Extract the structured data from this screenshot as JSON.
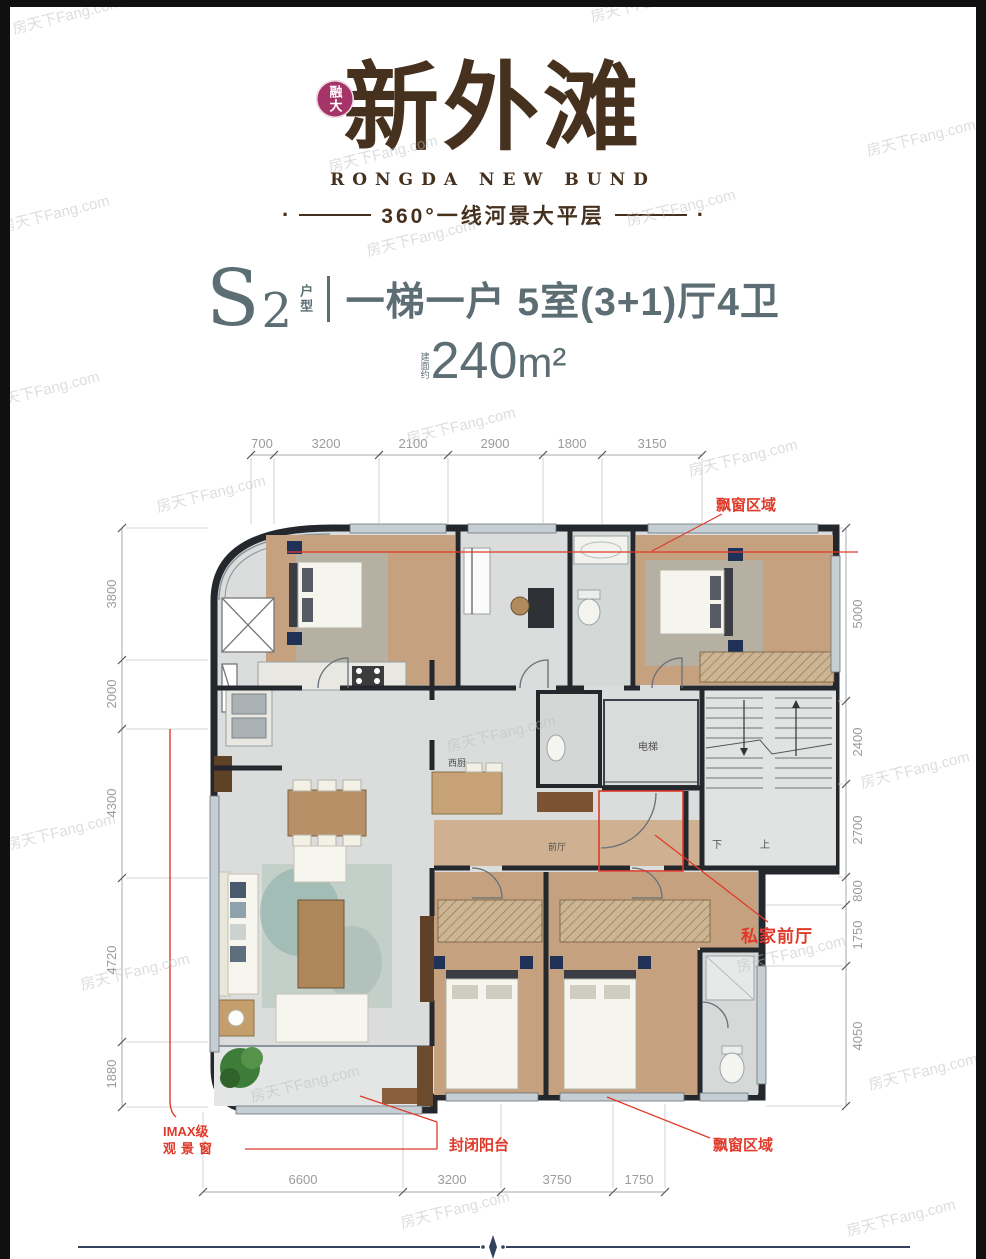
{
  "page": {
    "watermark": "房天下Fang.com"
  },
  "header": {
    "badge_text": "融大",
    "logo_title": "新外滩",
    "logo_subtitle": "RONGDA NEW BUND",
    "tagline": "360°一线河景大平层",
    "brand_color": "#46311e",
    "badge_color": "#a53568"
  },
  "unit": {
    "model_letter": "S",
    "model_number": "2",
    "model_label": "户型",
    "headline": "一梯一户 5室(3+1)厅4卫",
    "area_prefix": "建面约",
    "area_value": "240",
    "area_unit": "m²",
    "accent_color": "#5c6d73"
  },
  "floor_plan": {
    "dimensions_top": [
      "700",
      "3200",
      "2100",
      "2900",
      "1800",
      "3150"
    ],
    "dimensions_left": [
      "3800",
      "2000",
      "4300",
      "4720",
      "1880"
    ],
    "dimensions_right": [
      "5000",
      "2400",
      "2700",
      "800",
      "1750",
      "4050"
    ],
    "dimensions_bottom": [
      "6600",
      "3200",
      "3750",
      "1750"
    ],
    "rooms": {
      "west_kitchen": "西厨",
      "elevator": "电梯",
      "front_hall": "前厅",
      "stair_down": "下",
      "stair_up": "上"
    },
    "annotations": {
      "bay_window_top": "飘窗区域",
      "private_front_hall": "私家前厅",
      "imax_window_line1": "IMAX级",
      "imax_window_line2": "观景窗",
      "enclosed_balcony": "封闭阳台",
      "bay_window_bottom": "飘窗区域"
    },
    "annotation_color": "#e03a2a"
  }
}
